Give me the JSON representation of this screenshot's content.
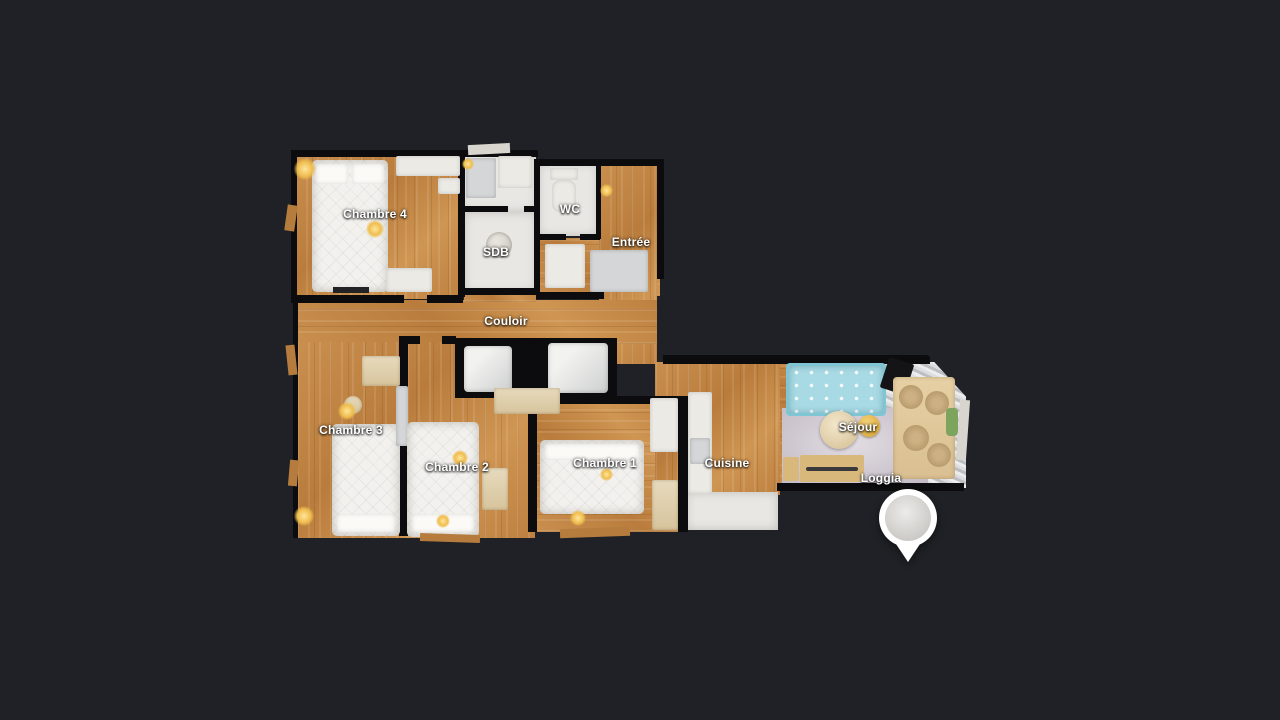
{
  "scene": {
    "type": "floorplan-viewer"
  },
  "colors": {
    "background": "#1f2126",
    "walls": "#0c0c0e",
    "wood_floor": "#c08547",
    "tile_floor": "#e9e7e3",
    "rug_floor": "#cfc8d1",
    "sofa": "#a7dae4",
    "sun_flare": "#efbd4e",
    "pin": "#ffffff",
    "pin_inner": "#dcdad6"
  },
  "rooms": [
    {
      "id": "chambre4",
      "label": "Chambre 4"
    },
    {
      "id": "sdb",
      "label": "SDB"
    },
    {
      "id": "wc",
      "label": "WC"
    },
    {
      "id": "entree",
      "label": "Entrée"
    },
    {
      "id": "couloir",
      "label": "Couloir"
    },
    {
      "id": "chambre3",
      "label": "Chambre 3"
    },
    {
      "id": "chambre2",
      "label": "Chambre 2"
    },
    {
      "id": "chambre1",
      "label": "Chambre 1"
    },
    {
      "id": "cuisine",
      "label": "Cuisine"
    },
    {
      "id": "sejour",
      "label": "Séjour"
    },
    {
      "id": "loggia",
      "label": "Loggia"
    }
  ],
  "marker": {
    "name": "panorama-location-pin"
  }
}
